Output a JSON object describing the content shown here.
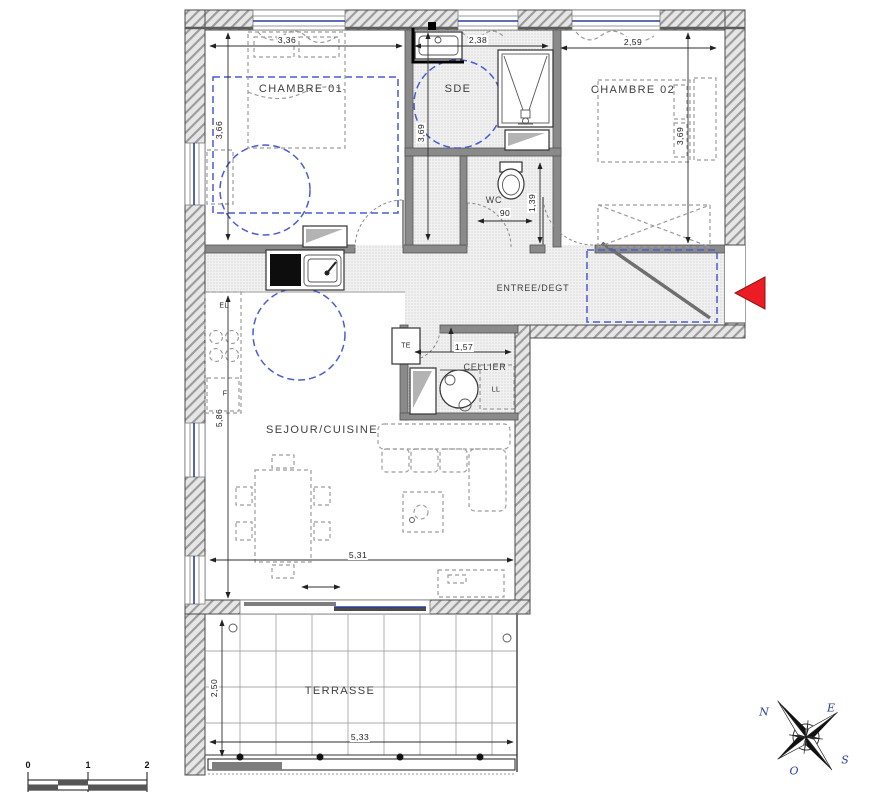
{
  "rooms": {
    "chambre01": "CHAMBRE 01",
    "sde": "SDE",
    "chambre02": "CHAMBRE 02",
    "wc": "WC",
    "entree": "ENTREE/DEGT",
    "cellier": "CELLIER",
    "sejour": "SEJOUR/CUISINE",
    "terrasse": "TERRASSE"
  },
  "equipment": {
    "te": "TE",
    "ll": "LL",
    "el": "EL",
    "f": "F"
  },
  "dimensions": {
    "chambre01_width": "3,36",
    "sde_width": "2,38",
    "chambre02_width": "2,59",
    "chambre01_height": "3,66",
    "sde_height": "3,69",
    "chambre02_height": "3,69",
    "wc_width": "90",
    "wc_height": "1,39",
    "cellier_width": "1,57",
    "sejour_height": "5,86",
    "sejour_width": "5,31",
    "terrasse_height": "2,50",
    "terrasse_width": "5,33"
  },
  "scale_bar": {
    "t0": "0",
    "t1": "1",
    "t2": "2"
  },
  "compass": {
    "n": "N",
    "e": "E",
    "s": "S",
    "o": "O"
  },
  "colors": {
    "accessibility_blue": "#4a5cd0",
    "entrance_red": "#ec1c24",
    "glazing_blue": "#2b3f9e"
  }
}
